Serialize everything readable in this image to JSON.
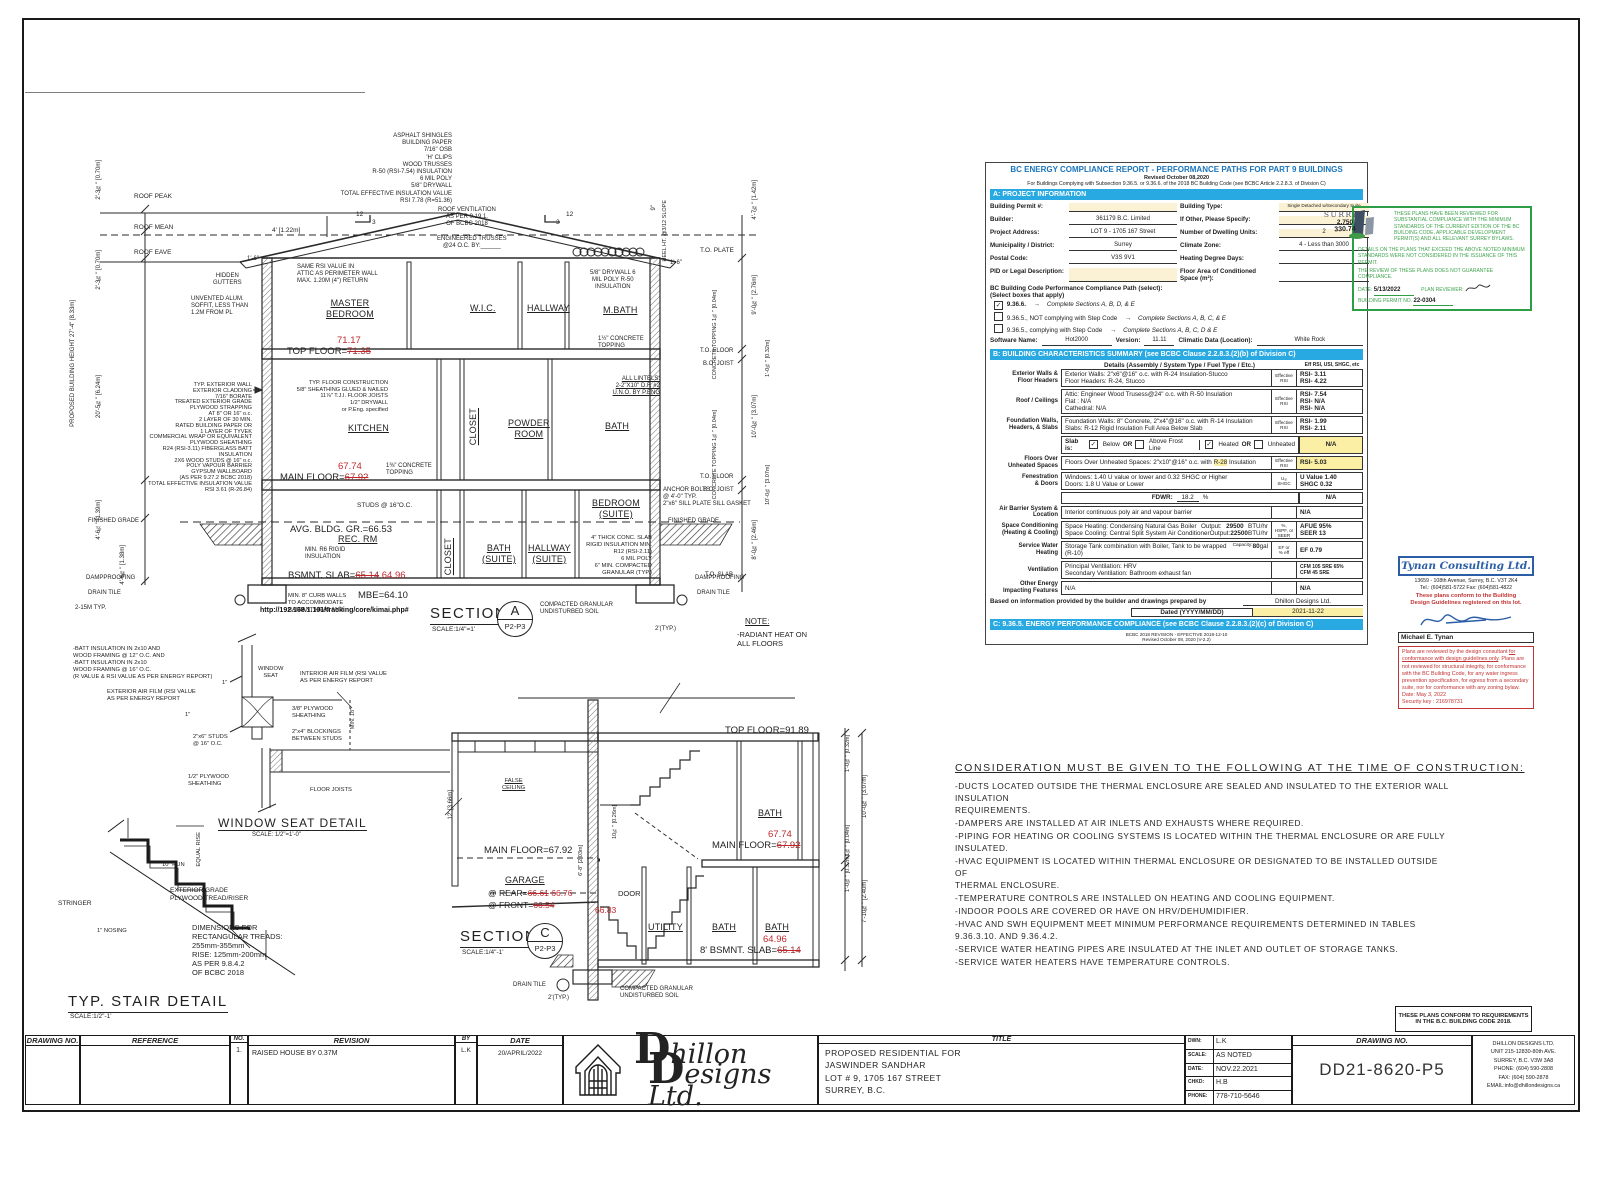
{
  "a": {
    "roof_note": "ASPHALT SHINGLES\nBUILDING PAPER\n7/16\" OSB\n'H' CLIPS\nWOOD TRUSSES\nR-50 (RSI-7.54) INSULATION\n6 MIL POLY\n5/8\" DRYWALL\nTOTAL EFFECTIVE INSULATION VALUE\nRSI 7.78 (R=51.36)",
    "roof_vent": "ROOF VENTILATION\nAS PER 9.19.1.\nOF BCBC 2018",
    "trusses": "ENGINEERED TRUSSES\n@24 O.C. BY:______",
    "slope_rise": "12",
    "slope_run": "3",
    "roof_peak": "ROOF PEAK",
    "roof_mean": "ROOF MEAN",
    "roof_eave": "ROOF EAVE",
    "same_rsi": "SAME RSI VALUE IN\nATTIC AS PERIMETER WALL\nMAX. 1.20M (4\") RETURN",
    "hidden_gutters": "HIDDEN\nGUTTERS",
    "soffit": "UNVENTED ALUM.\nSOFFIT, LESS THAN\n1.2M FROM PL",
    "drywall_right": "5/8\" DRYWALL 6\nMIL POLY R-50\nINSULATION",
    "heel": "HEEL HT.\n@3/12 SLOPE",
    "heel9": "9\"",
    "to_plate": "T.O. PLATE",
    "dim4": "4' [1.22m]",
    "dim16l": "1'-6\"",
    "dim16r": "1'-6\"",
    "rooms": {
      "master": "MASTER\nBEDROOM",
      "wic": "W.I.C.",
      "hallway": "HALLWAY",
      "mbath": "M.BATH",
      "kitchen": "KITCHEN",
      "closetm": "CLOSET",
      "powder": "POWDER\nROOM",
      "bath": "BATH",
      "rec": "REC. RM",
      "closetb": "CLOSET",
      "baths": "BATH\n(SUITE)",
      "halls": "HALLWAY\n(SUITE)",
      "beds": "BEDROOM\n(SUITE)"
    },
    "top_floor_lbl": "TOP FLOOR=",
    "top_floor_old": "71.35",
    "top_floor_new": "71.17",
    "main_floor_lbl": "MAIN FLOOR=",
    "main_floor_old": "67.92",
    "main_floor_new": "67.74",
    "bsmt_lbl": "BSMNT. SLAB=",
    "bsmt_old": "65.14",
    "bsmt_new": "64.96",
    "avg_gr": "AVG. BLDG. GR.=66.53",
    "mbe": "MBE=64.10",
    "ext_wall_note": "TYP. EXTERIOR WALL\nEXTERIOR CLADDING\n7/16\" BORATE\nTREATED EXTERIOR GRADE\nPLYWOOD STRAPPING\nAT 8\" OR 16\" o.c.\n2 LAYER OF 30 MIN.\nRATED BUILDING PAPER OR\n1 LAYER OF TYVEK\nCOMMERCIAL WRAP OR EQUIVALENT\nPLYWOOD SHEATHING\nR24 (RSI-3.11) FIBERGLASS BATT\nINSULATION\n2X6 WOOD STUDS @ 16\" o.c.\nPOLY VAPOUR BARRIER\nGYPSUM WALLBOARD\n(AS PER 9.27.2 BCBC 2018)\nTOTAL EFFECTIVE INSULATION VALUE\nRSI 3.61 (R-26.84)",
    "floor_note": "TYP. FLOOR CONSTRUCTION\n5/8\" SHEATHING GLUED & NAILED\n11⅞\" T.J.I. FLOOR JOISTS\n1/2\" DRYWALL\nor P.Eng. specified",
    "conc_top_u": "1½\" CONCRETE\nTOPPING",
    "conc_top_l": "1⅜\" CONCRETE\nTOPPING",
    "lintels": "ALL LINTELS:\n2-2\"X10\" D.F. #2\nU.N.O. BY P.ENG",
    "studs": "STUDS @ 16\"O.C.",
    "r6": "MIN. R6 RIGID\nINSULATION",
    "slab_note": "4\" THICK CONC. SLAB\nRIGID INSULATION MIN.\nR12 (RSI-2.11)\n6 MIL POLY\n6\" MIN. COMPACTED\nGRANULAR (TYP.)",
    "anchor": "ANCHOR BOLTS\n@ 4'-0\" TYP.\n2\"x6\" SILL PLATE SILL GASKET",
    "curb": "MIN. 8\" CURB WALLS\nTO ACCOMMODATE\nRADIANT HEAT AND",
    "fin_grade_l": "FINISHED GRADE",
    "fin_grade_r": "FINISHED GRADE",
    "damp_l": "DAMPPROOFING",
    "damp_r": "DAMPPROOFING",
    "drain_l": "DRAIN TILE",
    "drain_r": "DRAIN TILE",
    "bars": "2-15M TYP.",
    "granular": "COMPACTED GRANULAR\nUNDISTURBED SOIL",
    "ftg_dim": "2'(TYP.)",
    "title": "SECTION",
    "letter": "A",
    "scale": "SCALE:1/4\"=1'",
    "ref": "P2-P3",
    "dimsL": [
      "2'-3⅝\" [0.70m]",
      "2'-3⅝\" [0.70m]",
      "20'-5⅝\" [6.24m]",
      "4'-6¾\" [1.39m]",
      "4'-6⅝\" [1.38m]"
    ],
    "bldg_height": "PROPOSED BUILDING HEIGHT\n27'-4\" [8.33m]",
    "dimsR": [
      "4'-7⅝\" [1.42m]",
      "9'-0⅝\" [2.76m]",
      "1'-0⅝\" [0.32m]",
      "10'-0⅝\" [3.07m]",
      "1'-0⅝\" [0.32m]",
      "8'-0⅝\" [2.46m]"
    ],
    "to_floor1": "T.O. FLOOR",
    "bo_joist1": "B.O. JOIST",
    "to_floor2": "T.O. FLOOR",
    "bo_joist2": "B.O. JOIST",
    "to_slab": "T.O. SLAB",
    "conc_dim": "CONCRETE TOPPING\n1⅝\" [0.04m]"
  },
  "wm": "http://192.168.1.101/tracking/core/kimai.php#",
  "ws": {
    "batt": "-BATT INSULATION IN 2x10 AND\nWOOD FRAMING @ 12\" O.C. AND\n-BATT INSULATION IN 2x10\nWOOD FRAMING @ 16\" O.C.\n(R VALUE & RSI VALUE AS PER ENERGY REPORT)",
    "ext_film": "EXTERIOR AIR FILM (RSI VALUE\nAS PER ENERGY REPORT",
    "int_film": "INTERIOR AIR FILM (RSI VALUE\nAS PER ENERGY REPORT",
    "seat": "WINDOW\nSEAT",
    "ply38": "3/8\" PLYWOOD\nSHEATHING",
    "blocking": "2\"x4\" BLOCKINGS\nBETWEEN STUDS",
    "studs": "2\"x6\" STUDS\n@ 16\" O.C.",
    "ply12": "1/2\" PLYWOOD\nSHEATHING",
    "joists": "FLOOR JOISTS",
    "min18": "MIN. 18\"",
    "one_a": "1\"",
    "one_b": "1\"",
    "title": "WINDOW SEAT DETAIL",
    "scale": "SCALE: 1/2\"=1'-0\""
  },
  "stair": {
    "equal_rise": "EQUAL RISE",
    "run": "10\" RUN",
    "stringer": "STRINGER",
    "tread": "EXTERIOR GRADE\nPLYWOOD TREAD/RISER",
    "nosing": "1\" NOSING",
    "dims": "DIMENSIONS FOR\nRECTANGULAR TREADS:\n255mm-355mm\nRISE: 125mm-200mm\nAS PER 9.8.4.2\nOF BCBC 2018",
    "title": "TYP. STAIR DETAIL",
    "scale": "SCALE:1/2\"-1'"
  },
  "c": {
    "note_head": "NOTE:",
    "note_body": "-RADIANT HEAT ON\nALL FLOORS",
    "top_floor": "TOP FLOOR=91.89",
    "false_ceiling": "FALSE\nCEILING",
    "main_l": "MAIN FLOOR=67.92",
    "garage": "GARAGE",
    "rear_lbl": "@ REAR=",
    "rear_old": "66.61",
    "rear_new": "66.76",
    "front_lbl": "@ FRONT=",
    "front_old": "66.54",
    "front_new": "66.83",
    "door": "DOOR",
    "bath_u": "BATH",
    "main_r_lbl": "MAIN FLOOR=",
    "main_r_old": "67.92",
    "main_r_new": "67.74",
    "utility": "UTILITY",
    "bath_b1": "BATH",
    "bath_b2": "BATH",
    "bsmt_lbl": "8' BSMNT. SLAB=",
    "bsmt_old": "65.14",
    "bsmt_new": "64.96",
    "title": "SECTION",
    "letter": "C",
    "scale": "SCALE:1/4\"-1'",
    "ref": "P2-P3",
    "drain": "DRAIN TILE",
    "ftg": "2'(TYP.)",
    "granular": "COMPACTED GRANULAR\nUNDISTURBED SOIL",
    "dim12": "12' [3.66m]",
    "dim1034": "10¾\" [0.26m]",
    "dim68": "6'-8\" [2.03m]",
    "dimsR": [
      "1'-0⅝\" [0.32m]",
      "10'-0⅝\" [3.07m]",
      "1⅝\" [0.04m]",
      "1'-0⅝\" [0.32m]",
      "7'-10⅝\" [2.40m]"
    ]
  },
  "er": {
    "title": "BC ENERGY COMPLIANCE REPORT - PERFORMANCE PATHS FOR PART 9 BUILDINGS",
    "revised": "Revised October 08,2020",
    "subtitle": "For Buildings Complying with Subsection 9.36.5. or 9.36.6. of the 2018 BC Building Code (see BCBC Article 2.2.8.3. of Division C)",
    "secA": "A: PROJECT INFORMATION",
    "fieldsL": [
      {
        "label": "Building Permit #:",
        "value": ""
      },
      {
        "label": "Builder:",
        "value": "361179 B.C. Limited"
      },
      {
        "label": "Project Address:",
        "value": "LOT 9 - 1705 167 Street"
      },
      {
        "label": "Municipality / District:",
        "value": "Surrey"
      },
      {
        "label": "Postal Code:",
        "value": "V3S 9V1"
      },
      {
        "label": "PID or Legal Description:",
        "value": ""
      }
    ],
    "fieldsR": [
      {
        "label": "Building Type:",
        "value": "Single Detached w/Secondary Suite"
      },
      {
        "label": "If Other, Please Specify:",
        "value": ""
      },
      {
        "label": "Number of Dwelling Units:",
        "value": "2"
      },
      {
        "label": "Climate Zone:",
        "value": "4 - Less than 3000"
      },
      {
        "label": "Heating Degree Days:",
        "value": ""
      },
      {
        "label": "Floor Area of Conditioned Space (m²):",
        "value": ""
      }
    ],
    "path_head": "BC Building Code Performance Compliance Path (select):",
    "path_sub": "(Select boxes that apply)",
    "arrow": "→",
    "paths": [
      {
        "mark": "✓",
        "code": "9.36.6.",
        "complete": "Complete Sections A, B, D, & E"
      },
      {
        "mark": "",
        "code": "9.36.5., NOT complying with Step Code",
        "complete": "Complete Sections A, B, C, & E"
      },
      {
        "mark": "",
        "code": "9.36.5., complying with Step Code",
        "complete": "Complete Sections A, B, C, D & E"
      }
    ],
    "software_lbl": "Software Name:",
    "software": "Hot2000",
    "version_lbl": "Version:",
    "version": "11.11",
    "climatic_lbl": "Climatic Data (Location):",
    "climatic": "White Rock",
    "secB": "B: BUILDING CHARACTERISTICS SUMMARY (see BCBC Clause 2.2.8.3.(2)(b) of Division C)",
    "col_details": "Details (Assembly / System Type / Fuel Type / Etc.)",
    "col_eff": "Eff RSI, USI, SHGC, etc",
    "eff": "Effective\nRSI",
    "r1": {
      "label": "Exterior Walls &\nFloor Headers",
      "l1": "Exterior Walls: 2\"x6\"@16\" o.c. with R-24 Insulation-Stucco",
      "l2": "Floor Headers: R-24, Stucco",
      "v1": "RSI- 3.11",
      "v2": "RSI- 4.22"
    },
    "r2": {
      "label": "Roof / Ceilings",
      "l1": "Attic: Engineer Wood Trusess@24\" o.c. with R-50 Insulation",
      "l2": "Flat : N/A",
      "l3": "Cathedral: N/A",
      "v1": "RSI- 7.54",
      "v2": "RSI- N/A",
      "v3": "RSI- N/A"
    },
    "r3": {
      "label": "Foundation Walls,\nHeaders, & Slabs",
      "l1": "Foundation Walls: 8\" Concrete, 2\"x4\"@16\" o.c. with R-14 Insulation",
      "l2": "Slabs: R-12 Rigid Insulation Full Area Below Slab",
      "v1": "RSI- 1.99",
      "v2": "RSI- 2.11"
    },
    "slab": {
      "lbl": "Slab is:",
      "m1": "✓",
      "t1": "Below",
      "or1": "OR",
      "m2": "",
      "t2": "Above Frost Line",
      "m3": "✓",
      "t3": "Heated",
      "or2": "OR",
      "m4": "",
      "t4": "Unheated",
      "val": "N/A"
    },
    "r4": {
      "label": "Floors Over\nUnheated Spaces",
      "pre": "Floors Over  Unheated Spaces: 2\"x10\"@16\" o.c. with ",
      "hl": "R-28",
      "post": " Insulation",
      "v1": "RSI- 5.03"
    },
    "r5": {
      "label": "Fenestration\n& Doors",
      "l1": "Windows: 1.40 U value or lower and 0.32 SHGC or Higher",
      "l2": "Doors: 1.8 U Value or Lower",
      "eff": "U₅ᵢ\nSHGC",
      "v1": "U Value 1.40",
      "v2": "SHGC 0.32"
    },
    "fdwr": {
      "lbl": "FDWR:",
      "val": "18.2",
      "pct": "%",
      "na": "N/A"
    },
    "r6": {
      "label": "Air Barrier System &\nLocation",
      "l1": "Interior continuous poly air and vapour barrier",
      "v1": "N/A"
    },
    "r7": {
      "label": "Space Conditioning\n(Heating & Cooling)",
      "l1": "Space Heating: Condensing Natural Gas Boiler",
      "o1l": "Output:",
      "o1": "29500",
      "u1": "BTU/hr",
      "l2": "Space Cooling: Central Split System Air Conditioner",
      "o2l": "Output:",
      "o2": "22500",
      "u2": "BTU/hr",
      "eff": "%,\nHSPF, or\nSEER",
      "v1": "AFUE 95%",
      "v2": "SEER 13"
    },
    "r8": {
      "label": "Service Water\nHeating",
      "l1": "Storage Tank combination with Boiler, Tank to be wrapped  (R-10)",
      "cl": "Capacity:",
      "cap": "80",
      "gal": "gal",
      "eff": "EF or\n% eff",
      "v1": "EF 0.79"
    },
    "r9": {
      "label": "Ventilation",
      "l1": "Principal Ventilation: HRV",
      "l2": "Secondary Ventilation: Bathroom exhaust fan",
      "v1": "CFM  105    SRE  65%",
      "v2": "CFM  45    SRE"
    },
    "r10": {
      "label": "Other Energy\nImpacting Features",
      "l1": "N/A",
      "v1": "N/A"
    },
    "based": "Based on information provided by the builder and drawings prepared by",
    "based_val": "Dhillon Designs Ltd.",
    "dated_lbl": "Dated (YYYY/MM/DD)",
    "dated": "2021-11-22",
    "secC": "C: 9.36.5. ENERGY PERFORMANCE COMPLIANCE (see BCBC Clause 2.2.8.3.(2)(c) of Division C)",
    "rev1": "BCBC 2018 REVISION - EFFECTIVE 2018-12-10",
    "rev2": "Revised October 08, 2020 (V-2.2)"
  },
  "surrey": {
    "logo_text": "SURREY",
    "hdd": "2,750",
    "area": "330.74",
    "p1": "THESE PLANS HAVE BEEN REVIEWED FOR SUBSTANTIAL COMPLIANCE WITH THE MINIMUM STANDARDS OF THE CURRENT EDITION OF THE BC BUILDING CODE, APPLICABLE DEVELOPMENT PERMIT(S) AND ALL RELEVANT SURREY BYLAWS.",
    "p2": "DETAILS ON THE PLANS THAT EXCEED THE ABOVE NOTED MINIMUM STANDARDS WERE NOT CONSIDERED IN THE ISSUANCE OF THIS PERMIT.",
    "p3": "THE REVIEW OF THESE PLANS DOES NOT GUARANTEE COMPLIANCE.",
    "date_lbl": "DATE:",
    "date": "5/13/2022",
    "reviewer_lbl": "PLAN REVIEWER:",
    "permit_lbl": "BUILDING PERMIT NO.",
    "permit": "22-0304"
  },
  "tynan": {
    "name": "Tynan Consulting Ltd.",
    "addr1": "13659 - 108th Avenue, Surrey, B.C. V3T 2K4",
    "addr2": "Tel.: (604)581-5722   Fax: (604)581-4822",
    "conform": "These plans conform to the Building\nDesign Guidelines registered on this lot.",
    "signer": "Michael E. Tynan",
    "d1": "Plans are reviewed by the design consultant ",
    "du": "for conformance with design guidelines only",
    "d2": ". Plans are not reviewed for structural integrity, for conformance with the BC Building Code, for any water ingress prevention specification, for egress from a secondary suite, nor for conformance with any zoning bylaw.",
    "date": "Date: May 3, 2022",
    "key": "Security key : 216978731"
  },
  "consider": {
    "title": "CONSIDERATION  MUST  BE  GIVEN  TO  THE  FOLLOWING  AT  THE  TIME  OF  CONSTRUCTION:",
    "lines": [
      "-DUCTS  LOCATED  OUTSIDE  THE  THERMAL  ENCLOSURE  ARE  SEALED  AND  INSULATED  TO  THE  EXTERIOR  WALL\nINSULATION\nREQUIREMENTS.",
      "-DAMPERS  ARE  INSTALLED  AT  AIR  INLETS  AND  EXHAUSTS  WHERE  REQUIRED.",
      "-PIPING  FOR  HEATING  OR  COOLING  SYSTEMS  IS  LOCATED  WITHIN  THE  THERMAL  ENCLOSURE  OR  ARE  FULLY\nINSULATED.",
      "-HVAC  EQUIPMENT  IS  LOCATED  WITHIN  THERMAL  ENCLOSURE  OR  DESIGNATED  TO  BE  INSTALLED  OUTSIDE  OF\nTHERMAL  ENCLOSURE.",
      "-TEMPERATURE  CONTROLS  ARE  INSTALLED  ON  HEATING  AND  COOLING  EQUIPMENT.",
      "-INDOOR  POOLS  ARE  COVERED  OR  HAVE  ON  HRV/DEHUMIDIFIER.",
      "-HVAC  AND  SWH  EQUIPMENT  MEET  MINIMUM  PERFORMANCE  REQUIREMENTS  DETERMINED  IN  TABLES\n9.36.3.10.  AND  9.36.4.2.",
      "-SERVICE  WATER  HEATING  PIPES  ARE  INSULATED  AT  THE  INLET  AND  OUTLET  OF  STORAGE  TANKS.",
      "-SERVICE  WATER  HEATERS  HAVE  TEMPERATURE  CONTROLS."
    ]
  },
  "tb": {
    "h_drawing_no": "DRAWING NO.",
    "h_reference": "REFERENCE",
    "h_no": "NO.",
    "h_revision": "REVISION",
    "h_by": "BY",
    "h_date": "DATE",
    "rev_no": "1.",
    "rev_text": "RAISED  HOUSE  BY  0.37M",
    "rev_by": "L.K",
    "rev_date": "20/APRIL/2022",
    "logo_d1": "D",
    "logo_rest1": "hillon",
    "logo_d2": "D",
    "logo_rest2": "esigns Ltd.",
    "h_title": "TITLE",
    "title_lines": "PROPOSED  RESIDENTIAL  FOR\nJASWINDER  SANDHAR\nLOT  #  9,  1705  167  STREET\nSURREY,  B.C.",
    "dwn_lbl": "DWN:",
    "dwn": "L.K",
    "scale_lbl": "SCALE:",
    "scale": "AS  NOTED",
    "date_lbl": "DATE:",
    "date": "NOV.22.2021",
    "chkd_lbl": "CHKD:",
    "chkd": "H.B",
    "phone_lbl": "PHONE:",
    "phone": "778-710-5646",
    "h_drawing_no2": "DRAWING NO.",
    "drawing_no": "DD21-8620-P5",
    "company": "DHILLON  DESIG­NS  LTD.\nUNIT  215-12830-80th  AVE.\nSURREY,  B.C.  V3W  3A8\nPHONE:  (604)  590-2808\nFAX:  (604)  590-2878\nEMAIL:info@dhillondesigns.ca",
    "conform": "THESE PLANS CONFORM TO REQUIREMENTS\nIN THE B.C. BUILDING CODE 2018."
  }
}
